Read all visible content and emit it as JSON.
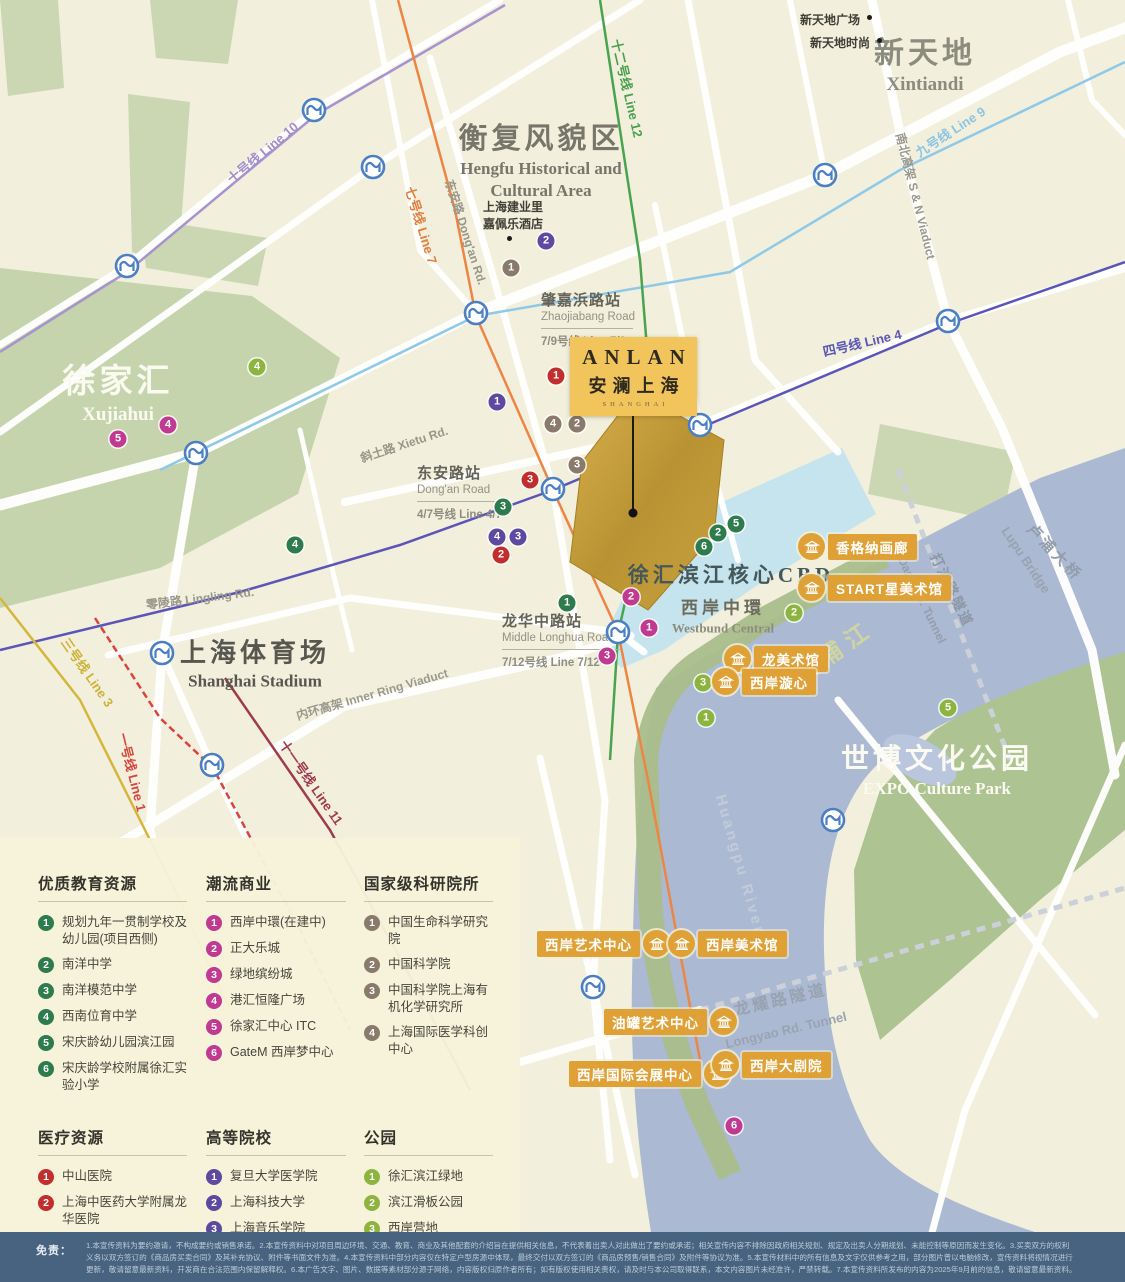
{
  "project": {
    "logo_en": "ANLAN",
    "logo_cn": "安澜上海",
    "logo_sub": "SHANGHAI"
  },
  "legend": {
    "sections": [
      {
        "id": "education",
        "title": "优质教育资源",
        "color": "#2e7b4d",
        "items": [
          "规划九年一贯制学校及幼儿园(项目西侧)",
          "南洋中学",
          "南洋模范中学",
          "西南位育中学",
          "宋庆龄幼儿园滨江园",
          "宋庆龄学校附属徐汇实验小学"
        ]
      },
      {
        "id": "commerce",
        "title": "潮流商业",
        "color": "#c13a92",
        "items": [
          "西岸中環(在建中)",
          "正大乐城",
          "绿地缤纷城",
          "港汇恒隆广场",
          "徐家汇中心 ITC",
          "GateM 西岸梦中心"
        ]
      },
      {
        "id": "research",
        "title": "国家级科研院所",
        "color": "#8a7a6c",
        "items": [
          "中国生命科学研究院",
          "中国科学院",
          "中国科学院上海有机化学研究所",
          "上海国际医学科创中心"
        ]
      },
      {
        "id": "medical",
        "title": "医疗资源",
        "color": "#c22e2e",
        "items": [
          "中山医院",
          "上海中医药大学附属龙华医院",
          "复旦大学附属肿瘤医院"
        ]
      },
      {
        "id": "university",
        "title": "高等院校",
        "color": "#5b4aa0",
        "items": [
          "复旦大学医学院",
          "上海科技大学",
          "上海音乐学院",
          "上海中医药大学"
        ]
      },
      {
        "id": "park",
        "title": "公园",
        "color": "#8cb43e",
        "items": [
          "徐汇滨江绿地",
          "滨江滑板公园",
          "西岸营地CAMP3399",
          "徐家汇公园",
          "世博文化公园"
        ]
      }
    ]
  },
  "map": {
    "area_labels": [
      {
        "id": "xintiandi",
        "cn": "新天地",
        "en": "Xintiandi",
        "x": 925,
        "y": 62,
        "cs": 30,
        "es": 19,
        "c": "#8b8b7e",
        "ec": "#8b8b7e"
      },
      {
        "id": "hengfu",
        "cn": "衡复风貌区",
        "en": "Hengfu Historical and",
        "en2": "Cultural Area",
        "x": 541,
        "y": 158,
        "cs": 29,
        "es": 17,
        "c": "#77766a",
        "ec": "#77766a"
      },
      {
        "id": "xujiahui",
        "cn": "徐家汇",
        "en": "Xujiahui",
        "x": 118,
        "y": 390,
        "cs": 33,
        "es": 19,
        "c": "#fbfaf0",
        "ec": "#fbfaf0"
      },
      {
        "id": "stadium",
        "cn": "上海体育场",
        "en": "Shanghai Stadium",
        "x": 255,
        "y": 662,
        "cs": 26,
        "es": 17,
        "c": "#57574f",
        "ec": "#57574f"
      },
      {
        "id": "expo",
        "cn": "世博文化公园",
        "en": "EXPO Culture Park",
        "x": 937,
        "y": 768,
        "cs": 28,
        "es": 17,
        "c": "#fbfaf0",
        "ec": "#fbfaf0"
      },
      {
        "id": "cbd",
        "cn": "徐汇滨江核心CBD",
        "en": "",
        "x": 731,
        "y": 574,
        "cs": 21,
        "es": 13,
        "c": "#44585a",
        "ec": "#44585a"
      },
      {
        "id": "westbund",
        "cn": "西岸中環",
        "en": "Westbund Central",
        "x": 723,
        "y": 615,
        "cs": 17,
        "es": 13,
        "c": "#6b6b5e",
        "ec": "#8c8c7e"
      }
    ],
    "rotated_labels": [
      {
        "id": "line10",
        "text": "十号线  Line 10",
        "x": 262,
        "y": 152,
        "r": -40,
        "c": "#a18fc8",
        "s": 13
      },
      {
        "id": "line7",
        "text": "七号线  Line 7",
        "x": 422,
        "y": 225,
        "r": 73,
        "c": "#e08040",
        "s": 13
      },
      {
        "id": "line12",
        "text": "十二号线  Line 12",
        "x": 628,
        "y": 88,
        "r": 77,
        "c": "#4aa04c",
        "s": 13
      },
      {
        "id": "line9",
        "text": "九号线  Line 9",
        "x": 950,
        "y": 131,
        "r": -33,
        "c": "#8cc5e4",
        "s": 13
      },
      {
        "id": "line4",
        "text": "四号线  Line 4",
        "x": 862,
        "y": 342,
        "r": -13,
        "c": "#5a55b8",
        "s": 13
      },
      {
        "id": "line3",
        "text": "三号线  Line 3",
        "x": 88,
        "y": 672,
        "r": 55,
        "c": "#cdb23a",
        "s": 13
      },
      {
        "id": "line1",
        "text": "一号线  Line 1",
        "x": 133,
        "y": 772,
        "r": 76,
        "c": "#d8453c",
        "s": 13
      },
      {
        "id": "line11",
        "text": "十一号线  Line 11",
        "x": 312,
        "y": 782,
        "r": 55,
        "c": "#a03a50",
        "s": 13
      },
      {
        "id": "dongan-rd",
        "text": "东安路 Dong'an Rd.",
        "x": 466,
        "y": 232,
        "r": 72,
        "c": "#98978a",
        "s": 12
      },
      {
        "id": "xietu-rd",
        "text": "斜土路 Xietu Rd.",
        "x": 404,
        "y": 444,
        "r": -18,
        "c": "#98978a",
        "s": 12
      },
      {
        "id": "lingling-rd",
        "text": "零陵路 Lingling Rd.",
        "x": 200,
        "y": 598,
        "r": -7,
        "c": "#98978a",
        "s": 12
      },
      {
        "id": "inner-ring",
        "text": "内环高架 Inner Ring Viaduct",
        "x": 372,
        "y": 694,
        "r": -16,
        "c": "#9a998c",
        "s": 12
      },
      {
        "id": "sn-viaduct",
        "text": "南北高架 S & N Viaduct",
        "x": 916,
        "y": 196,
        "r": 76,
        "c": "#9a998c",
        "s": 12
      },
      {
        "id": "huangpu-cn",
        "text": "黄浦江",
        "x": 833,
        "y": 650,
        "r": -35,
        "c": "#d0d5a0",
        "s": 23,
        "ls": 8
      },
      {
        "id": "huangpu-en",
        "text": "Huangpu River",
        "x": 740,
        "y": 865,
        "r": 74,
        "c": "#c3cbda",
        "s": 15,
        "ls": 3
      },
      {
        "id": "lupu-cn",
        "text": "卢浦大桥",
        "x": 1055,
        "y": 552,
        "r": 46,
        "c": "#939cab",
        "s": 15,
        "ls": 3
      },
      {
        "id": "lupu-en",
        "text": "Lupu Bridge",
        "x": 1026,
        "y": 560,
        "r": 56,
        "c": "#99a2b0",
        "s": 13
      },
      {
        "id": "dapu-cn",
        "text": "打浦路隧道",
        "x": 952,
        "y": 590,
        "r": 64,
        "c": "#8e97a7",
        "s": 14,
        "ls": 2
      },
      {
        "id": "dapu-en",
        "text": "Dapu Rd. Tunnel",
        "x": 922,
        "y": 600,
        "r": 64,
        "c": "#949dac",
        "s": 12
      },
      {
        "id": "longyao-cn",
        "text": "龙耀路隧道",
        "x": 780,
        "y": 998,
        "r": -13,
        "c": "#99a2b2",
        "s": 16,
        "ls": 3
      },
      {
        "id": "longyao-en",
        "text": "Longyao Rd. Tunnel",
        "x": 786,
        "y": 1030,
        "r": -13,
        "c": "#9aa3b2",
        "s": 13
      }
    ],
    "stations": [
      {
        "id": "zhaojiabang",
        "cn": "肇嘉浜路站",
        "en": "Zhaojiabang Road",
        "line": "7/9号线 Line 7/9",
        "x": 541,
        "y": 289,
        "w": 92
      },
      {
        "id": "dongan",
        "cn": "东安路站",
        "en": "Dong'an Road",
        "line": "4/7号线 Line 4/7",
        "x": 417,
        "y": 462,
        "w": 88
      },
      {
        "id": "longhua",
        "cn": "龙华中路站",
        "en": "Middle Longhua Road",
        "line": "7/12号线 Line 7/12",
        "x": 502,
        "y": 610,
        "w": 118
      }
    ],
    "pois": [
      {
        "id": "xtd-plaza",
        "text": "新天地广场",
        "x": 800,
        "y": 11
      },
      {
        "id": "xtd-style",
        "text": "新天地时尚",
        "x": 810,
        "y": 34
      },
      {
        "id": "hotel-1",
        "text": "上海建业里",
        "x": 513,
        "y": 198,
        "center": true
      },
      {
        "id": "hotel-2",
        "text": "嘉佩乐酒店",
        "x": 513,
        "y": 215,
        "center": true
      }
    ],
    "dots": [
      {
        "x": 869,
        "y": 17
      },
      {
        "x": 879,
        "y": 40
      },
      {
        "x": 509,
        "y": 238
      }
    ],
    "landmarks": [
      {
        "text": "香格纳画廊",
        "x": 798,
        "y": 533,
        "side": "left"
      },
      {
        "text": "START星美术馆",
        "x": 798,
        "y": 574,
        "side": "left"
      },
      {
        "text": "龙美术馆",
        "x": 724,
        "y": 645,
        "side": "left"
      },
      {
        "text": "西岸漩心",
        "x": 712,
        "y": 668,
        "side": "left"
      },
      {
        "text": "西岸艺术中心",
        "x": 537,
        "y": 930,
        "side": "right"
      },
      {
        "text": "西岸美术馆",
        "x": 668,
        "y": 930,
        "side": "left"
      },
      {
        "text": "油罐艺术中心",
        "x": 604,
        "y": 1008,
        "side": "right"
      },
      {
        "text": "西岸国际会展中心",
        "x": 569,
        "y": 1060,
        "side": "right"
      },
      {
        "text": "西岸大剧院",
        "x": 712,
        "y": 1051,
        "side": "left"
      }
    ],
    "poi_badges": [
      {
        "cat": "education",
        "n": 1,
        "x": 567,
        "y": 603
      },
      {
        "cat": "education",
        "n": 2,
        "x": 718,
        "y": 533
      },
      {
        "cat": "education",
        "n": 3,
        "x": 503,
        "y": 507
      },
      {
        "cat": "education",
        "n": 4,
        "x": 295,
        "y": 545
      },
      {
        "cat": "education",
        "n": 5,
        "x": 736,
        "y": 524
      },
      {
        "cat": "education",
        "n": 6,
        "x": 704,
        "y": 547
      },
      {
        "cat": "commerce",
        "n": 1,
        "x": 649,
        "y": 628
      },
      {
        "cat": "commerce",
        "n": 2,
        "x": 631,
        "y": 597
      },
      {
        "cat": "commerce",
        "n": 3,
        "x": 607,
        "y": 656
      },
      {
        "cat": "commerce",
        "n": 4,
        "x": 168,
        "y": 425
      },
      {
        "cat": "commerce",
        "n": 5,
        "x": 118,
        "y": 439
      },
      {
        "cat": "commerce",
        "n": 6,
        "x": 734,
        "y": 1126
      },
      {
        "cat": "research",
        "n": 1,
        "x": 511,
        "y": 268
      },
      {
        "cat": "research",
        "n": 2,
        "x": 577,
        "y": 424
      },
      {
        "cat": "research",
        "n": 3,
        "x": 577,
        "y": 465
      },
      {
        "cat": "research",
        "n": 4,
        "x": 553,
        "y": 424
      },
      {
        "cat": "medical",
        "n": 1,
        "x": 556,
        "y": 376
      },
      {
        "cat": "medical",
        "n": 2,
        "x": 501,
        "y": 555
      },
      {
        "cat": "medical",
        "n": 3,
        "x": 530,
        "y": 480
      },
      {
        "cat": "university",
        "n": 1,
        "x": 497,
        "y": 402
      },
      {
        "cat": "university",
        "n": 2,
        "x": 546,
        "y": 241
      },
      {
        "cat": "university",
        "n": 3,
        "x": 518,
        "y": 537
      },
      {
        "cat": "university",
        "n": 4,
        "x": 497,
        "y": 537
      },
      {
        "cat": "park",
        "n": 1,
        "x": 706,
        "y": 718
      },
      {
        "cat": "park",
        "n": 2,
        "x": 794,
        "y": 613
      },
      {
        "cat": "park",
        "n": 3,
        "x": 703,
        "y": 683
      },
      {
        "cat": "park",
        "n": 4,
        "x": 257,
        "y": 367
      },
      {
        "cat": "park",
        "n": 5,
        "x": 948,
        "y": 708
      }
    ],
    "metro_icons": [
      {
        "x": 314,
        "y": 110
      },
      {
        "x": 373,
        "y": 167
      },
      {
        "x": 825,
        "y": 175
      },
      {
        "x": 476,
        "y": 313
      },
      {
        "x": 948,
        "y": 321
      },
      {
        "x": 127,
        "y": 266
      },
      {
        "x": 196,
        "y": 453
      },
      {
        "x": 700,
        "y": 425
      },
      {
        "x": 553,
        "y": 489
      },
      {
        "x": 618,
        "y": 632
      },
      {
        "x": 162,
        "y": 653
      },
      {
        "x": 212,
        "y": 765
      },
      {
        "x": 833,
        "y": 820
      },
      {
        "x": 593,
        "y": 987
      }
    ]
  },
  "disclaimer": {
    "label": "免责：",
    "lines": [
      "1.本宣传资料为要约邀请，不构成要约或销售承诺。2.本宣传资料中对项目周边环境、交通、教育、商业及其他配套的介绍旨在提供相关信息，不代表着出卖人对此做出了要约或承诺；相关宣传内容不排除因政府相关规划、规定及出卖人分期规划、未能控制等原因而发生变化。3.买卖双方的权利",
      "义务以双方签订的《商品房买卖合同》及其补充协议、附件等书面文件为准。4.本宣传资料中部分内容仅在特定户型房源中体现，最终交付以双方签订的《商品房预售/销售合同》及附件等协议为准。5.本宣传材料中的所有信息及文字仅供参考之用，部分图片曾以电脑修改，宣传资料将视情况进行",
      "更新，敬请留意最新资料，开发商在合法范围内保留解释权。6.本广告文字、图片、数据等素材部分源于网络，内容版权归原作者所有；如有版权使用相关责权，请及时与本公司取得联系，本文内容图片未经准许，严禁转载。7.本宣传资料所发布的内容为2025年9月前的信息，敬请留意最新资料。"
    ]
  }
}
